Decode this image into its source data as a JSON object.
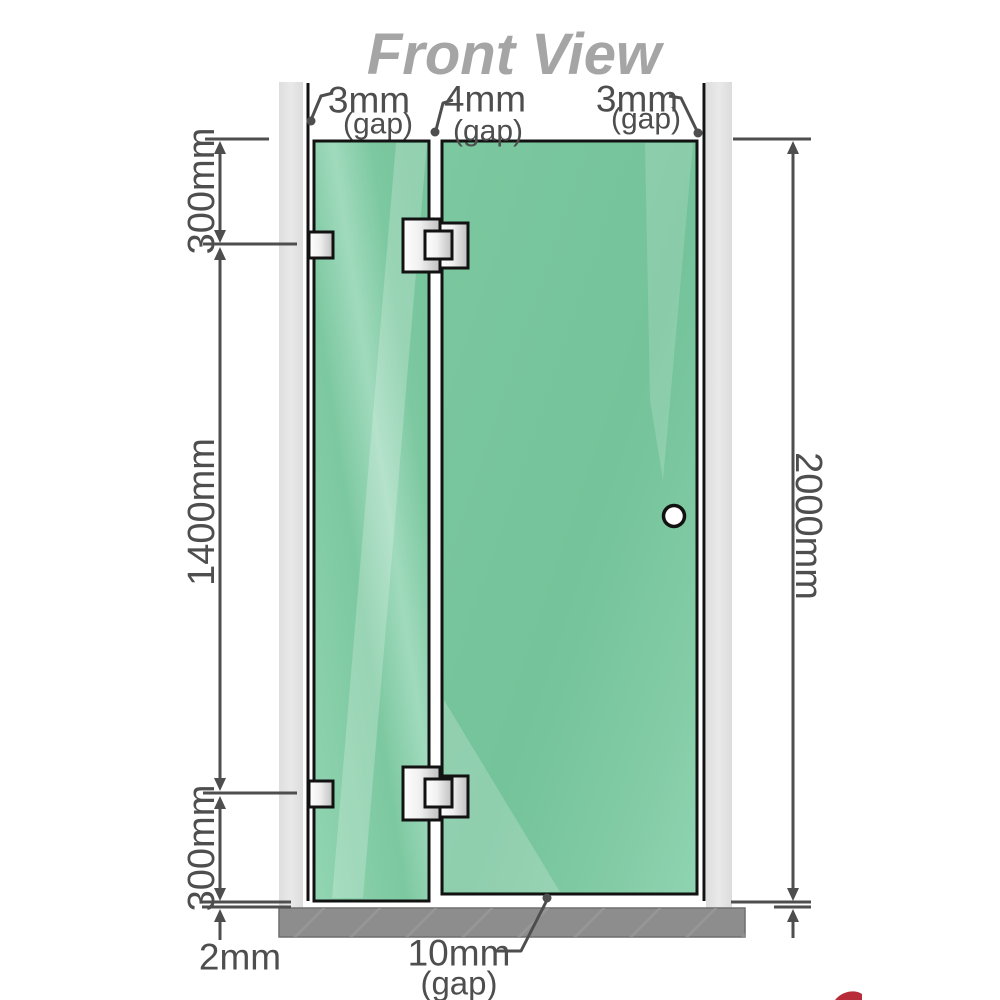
{
  "title": "Front View",
  "gaps": {
    "top_left": {
      "value": "3mm",
      "suffix": "(gap)"
    },
    "top_middle": {
      "value": "4mm",
      "suffix": "(gap)"
    },
    "top_right": {
      "value": "3mm",
      "suffix": "(gap)"
    },
    "bottom": {
      "value": "10mm",
      "suffix": "(gap)"
    },
    "floor": {
      "value": "2mm"
    }
  },
  "dimensions": {
    "left_top": "300mm",
    "left_middle": "1400mm",
    "left_bottom": "300mm",
    "right_overall": "2000mm"
  },
  "colors": {
    "glass": "#7ec9a2",
    "glass_dark": "#6fbf97",
    "glass_highlight": "#b9e6cf",
    "wall": "#e4e4e4",
    "floor": "#8d8d8d",
    "line": "#4e4e4e",
    "title": "#a5a5a5",
    "hinge_metal": "#e8e8e8",
    "logo_red": "#b01525"
  }
}
